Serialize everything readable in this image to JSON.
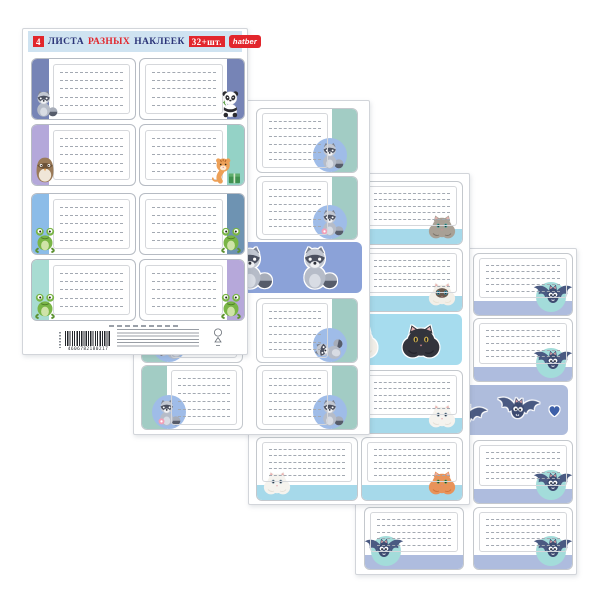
{
  "product": {
    "header": {
      "count": "4",
      "word_sheets": "ЛИСТА",
      "word_different": "РАЗНЫХ",
      "word_stickers": "НАКЛЕЕК",
      "qty": "32+шт.",
      "brand": "hatber",
      "bg_color": "#cfe3f1",
      "red_color": "#e2262c",
      "navy_color": "#2b3478"
    },
    "barcode_number": "4606782180217",
    "sheets": [
      {
        "key": "cover",
        "cells": [
          {
            "side": "l",
            "band": "#7684b6",
            "animal": "raccoon"
          },
          {
            "side": "r",
            "band": "#7684b6",
            "animal": "panda"
          },
          {
            "side": "l",
            "band": "#b4a8da",
            "animal": "owl"
          },
          {
            "side": "r",
            "band": "#94d2c6",
            "animal": "tiger"
          },
          {
            "side": "l",
            "band": "#8cbce8",
            "animal": "frog"
          },
          {
            "side": "r",
            "band": "#6e93b2",
            "animal": "frog"
          },
          {
            "side": "l",
            "band": "#a8dcd2",
            "animal": "frog"
          },
          {
            "side": "r",
            "band": "#b6a8da",
            "animal": "frog"
          }
        ]
      },
      {
        "key": "raccoons",
        "style": "side",
        "band": "#a2ccc4",
        "circle": "#9fbce8",
        "banner_bg": "#8ba2d8",
        "banner_items": [
          "raccoon_donut",
          "raccoon",
          "raccoon"
        ],
        "left": [
          "raccoon",
          "raccoon",
          "raccoon_sleep",
          "raccoon_donut"
        ],
        "right": [
          "raccoon",
          "raccoon_donut",
          "raccoon_sleep",
          "raccoon"
        ]
      },
      {
        "key": "cats",
        "style": "bottom",
        "band": "#a6d9ea",
        "banner_bg": "#a6dcee",
        "banner_items": [
          "cat_orange",
          "cat_siamese",
          "cat_black"
        ],
        "left": [
          "cat_gray",
          "cat_siamese",
          "cat_white",
          "cat_white"
        ],
        "right": [
          "cat_gray",
          "cat_siamese",
          "cat_white",
          "cat_orange"
        ]
      },
      {
        "key": "bats",
        "style": "bottom-circle",
        "band": "#aebcde",
        "circle": "#a3dcda",
        "banner_bg": "#aebcdc",
        "banner_items": [
          "bat",
          "heart",
          "bat",
          "bat",
          "heart"
        ],
        "left": [
          "bat",
          "bat",
          "bat",
          "bat"
        ],
        "right": [
          "bat",
          "bat",
          "bat",
          "bat"
        ]
      }
    ]
  }
}
